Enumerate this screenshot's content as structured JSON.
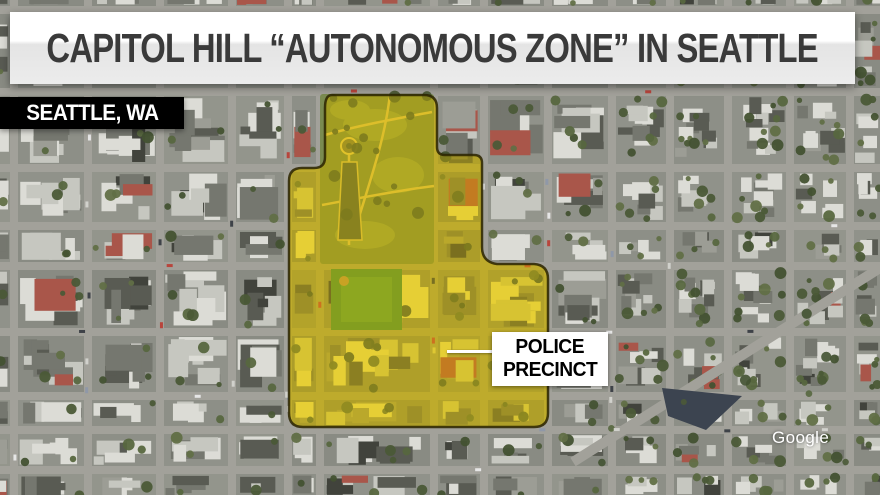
{
  "banner": {
    "headline": "CAPITOL HILL “AUTONOMOUS ZONE” IN SEATTLE"
  },
  "location_tag": {
    "label": "SEATTLE, WA"
  },
  "callout": {
    "line1": "POLICE",
    "line2": "PRECINCT"
  },
  "watermark": {
    "label": "Google"
  },
  "colors": {
    "zone_fill": "#ffdf00",
    "zone_fill_soft": "#ffe84d",
    "zone_outline": "#2a2300",
    "banner_text": "#3a3a3a",
    "location_bg": "#000000",
    "location_text": "#ffffff",
    "callout_bg": "#ffffff",
    "callout_text": "#000000",
    "street": "#a2a19a",
    "block": "#90928a",
    "park": "#7a8b50",
    "field": "#4e8d39"
  }
}
